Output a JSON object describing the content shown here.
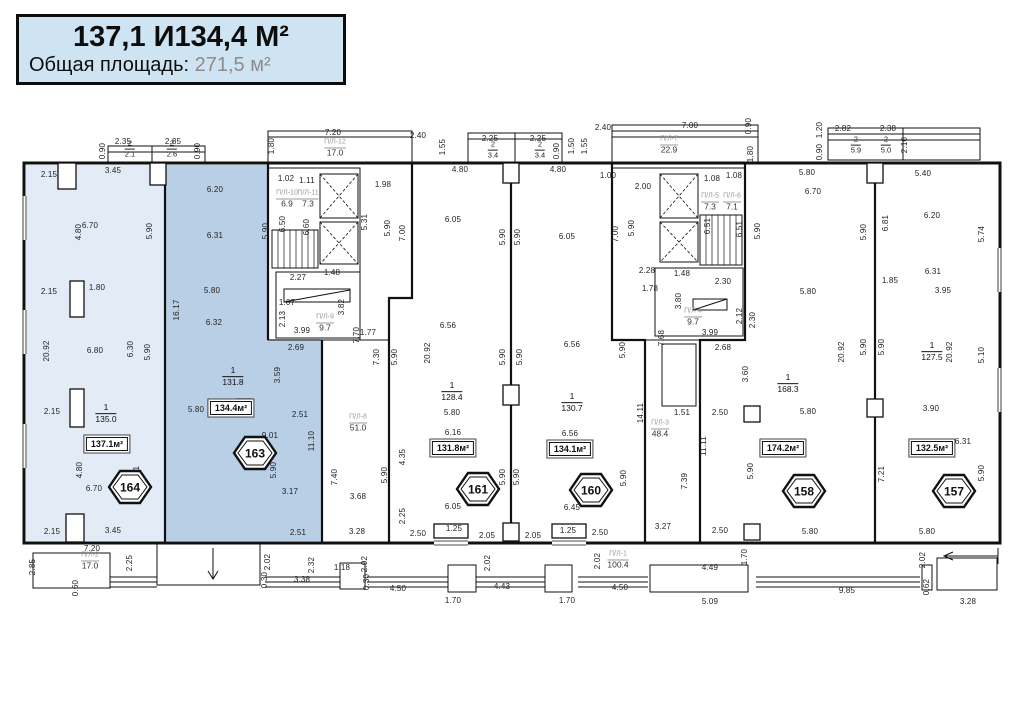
{
  "title": {
    "line1": "137,1 И134,4 М²",
    "line2_label": "Общая площадь:",
    "line2_value": "271,5 м²"
  },
  "plan": {
    "units": [
      {
        "id": "164",
        "total": "137.1м²",
        "num": "1",
        "living": "135.0",
        "hx": 107,
        "hy": 468,
        "bx": 107,
        "by": 444,
        "fx": 106,
        "fy": 414
      },
      {
        "id": "163",
        "total": "134.4м²",
        "num": "1",
        "living": "131.8",
        "hx": 232,
        "hy": 434,
        "bx": 231,
        "by": 408,
        "fx": 233,
        "fy": 377
      },
      {
        "id": "161",
        "total": "131.8м²",
        "num": "1",
        "living": "128.4",
        "hx": 455,
        "hy": 470,
        "bx": 453,
        "by": 448,
        "fx": 452,
        "fy": 392
      },
      {
        "id": "160",
        "total": "134.1м²",
        "num": "1",
        "living": "130.7",
        "hx": 568,
        "hy": 471,
        "bx": 570,
        "by": 449,
        "fx": 572,
        "fy": 403
      },
      {
        "id": "158",
        "total": "174.2м²",
        "num": "1",
        "living": "168.3",
        "hx": 781,
        "hy": 472,
        "bx": 783,
        "by": 448,
        "fx": 788,
        "fy": 384
      },
      {
        "id": "157",
        "total": "132.5м²",
        "num": "1",
        "living": "127.5",
        "hx": 931,
        "hy": 472,
        "bx": 932,
        "by": 448,
        "fx": 932,
        "fy": 352
      }
    ],
    "loggias": [
      {
        "x": 335,
        "y": 148,
        "name": "П/Л-12",
        "value": "17.0"
      },
      {
        "x": 669,
        "y": 145,
        "name": "П/Л-7",
        "value": "22.9"
      },
      {
        "x": 287,
        "y": 199,
        "name": "П/Л-10",
        "value": "6.9"
      },
      {
        "x": 308,
        "y": 199,
        "name": "П/Л-11",
        "value": "7.3"
      },
      {
        "x": 710,
        "y": 202,
        "name": "П/Л-5",
        "value": "7.3"
      },
      {
        "x": 732,
        "y": 202,
        "name": "П/Л-6",
        "value": "7.1"
      },
      {
        "x": 325,
        "y": 323,
        "name": "П/Л-9",
        "value": "9.7"
      },
      {
        "x": 693,
        "y": 317,
        "name": "П/Л-4",
        "value": "9.7"
      },
      {
        "x": 358,
        "y": 423,
        "name": "П/Л-8",
        "value": "51.0"
      },
      {
        "x": 660,
        "y": 429,
        "name": "П/Л-3",
        "value": "48.4"
      },
      {
        "x": 90,
        "y": 561,
        "name": "П/Л-2",
        "value": "17.0"
      },
      {
        "x": 618,
        "y": 560,
        "name": "П/Л-1",
        "value": "100.4"
      }
    ],
    "fractions": [
      {
        "x": 130,
        "y": 149,
        "num": "2",
        "den": "2.1"
      },
      {
        "x": 172,
        "y": 149,
        "num": "2",
        "den": "2.6"
      },
      {
        "x": 493,
        "y": 150,
        "num": "2",
        "den": "3.4"
      },
      {
        "x": 540,
        "y": 150,
        "num": "2",
        "den": "3.4"
      },
      {
        "x": 856,
        "y": 145,
        "num": "2",
        "den": "5.9"
      },
      {
        "x": 886,
        "y": 145,
        "num": "2",
        "den": "5.0"
      }
    ],
    "dims": [
      {
        "x": 103,
        "y": 151,
        "t": "0.90",
        "v": 1
      },
      {
        "x": 123,
        "y": 142,
        "t": "2.35"
      },
      {
        "x": 173,
        "y": 142,
        "t": "2.85"
      },
      {
        "x": 198,
        "y": 151,
        "t": "0.90",
        "v": 1
      },
      {
        "x": 272,
        "y": 146,
        "t": "1.80",
        "v": 1
      },
      {
        "x": 333,
        "y": 133,
        "t": "7.20"
      },
      {
        "x": 418,
        "y": 136,
        "t": "2.40"
      },
      {
        "x": 443,
        "y": 147,
        "t": "1.55",
        "v": 1
      },
      {
        "x": 490,
        "y": 139,
        "t": "2.25"
      },
      {
        "x": 538,
        "y": 139,
        "t": "2.25"
      },
      {
        "x": 557,
        "y": 151,
        "t": "0.90",
        "v": 1
      },
      {
        "x": 572,
        "y": 146,
        "t": "1.50",
        "v": 1
      },
      {
        "x": 603,
        "y": 128,
        "t": "2.40"
      },
      {
        "x": 585,
        "y": 146,
        "t": "1.55",
        "v": 1
      },
      {
        "x": 690,
        "y": 126,
        "t": "7.00"
      },
      {
        "x": 749,
        "y": 126,
        "t": "0.90",
        "v": 1
      },
      {
        "x": 751,
        "y": 154,
        "t": "1.80",
        "v": 1
      },
      {
        "x": 843,
        "y": 129,
        "t": "2.82"
      },
      {
        "x": 888,
        "y": 129,
        "t": "2.38"
      },
      {
        "x": 820,
        "y": 130,
        "t": "1.20",
        "v": 1
      },
      {
        "x": 820,
        "y": 152,
        "t": "0.90",
        "v": 1
      },
      {
        "x": 905,
        "y": 145,
        "t": "2.10",
        "v": 1
      },
      {
        "x": 460,
        "y": 170,
        "t": "4.80"
      },
      {
        "x": 558,
        "y": 170,
        "t": "4.80"
      },
      {
        "x": 608,
        "y": 176,
        "t": "1.00"
      },
      {
        "x": 643,
        "y": 187,
        "t": "2.00"
      },
      {
        "x": 712,
        "y": 179,
        "t": "1.08"
      },
      {
        "x": 734,
        "y": 176,
        "t": "1.08"
      },
      {
        "x": 807,
        "y": 173,
        "t": "5.80"
      },
      {
        "x": 923,
        "y": 174,
        "t": "5.40"
      },
      {
        "x": 49,
        "y": 175,
        "t": "2.15"
      },
      {
        "x": 113,
        "y": 171,
        "t": "3.45"
      },
      {
        "x": 90,
        "y": 226,
        "t": "6.70"
      },
      {
        "x": 79,
        "y": 232,
        "t": "4.80",
        "v": 1
      },
      {
        "x": 150,
        "y": 231,
        "t": "5.90",
        "v": 1
      },
      {
        "x": 49,
        "y": 292,
        "t": "2.15"
      },
      {
        "x": 97,
        "y": 288,
        "t": "1.80"
      },
      {
        "x": 47,
        "y": 351,
        "t": "20.92",
        "v": 1
      },
      {
        "x": 95,
        "y": 351,
        "t": "6.80"
      },
      {
        "x": 131,
        "y": 349,
        "t": "6.30",
        "v": 1
      },
      {
        "x": 148,
        "y": 352,
        "t": "5.90",
        "v": 1
      },
      {
        "x": 52,
        "y": 412,
        "t": "2.15"
      },
      {
        "x": 80,
        "y": 470,
        "t": "4.80",
        "v": 1
      },
      {
        "x": 94,
        "y": 489,
        "t": "6.70"
      },
      {
        "x": 137,
        "y": 474,
        "t": "7.21",
        "v": 1
      },
      {
        "x": 52,
        "y": 532,
        "t": "2.15"
      },
      {
        "x": 113,
        "y": 531,
        "t": "3.45"
      },
      {
        "x": 215,
        "y": 190,
        "t": "6.20"
      },
      {
        "x": 215,
        "y": 236,
        "t": "6.31"
      },
      {
        "x": 212,
        "y": 291,
        "t": "5.80"
      },
      {
        "x": 214,
        "y": 323,
        "t": "6.32"
      },
      {
        "x": 177,
        "y": 310,
        "t": "16.17",
        "v": 1
      },
      {
        "x": 266,
        "y": 231,
        "t": "5.90",
        "v": 1
      },
      {
        "x": 296,
        "y": 348,
        "t": "2.69"
      },
      {
        "x": 278,
        "y": 375,
        "t": "3.59",
        "v": 1
      },
      {
        "x": 300,
        "y": 415,
        "t": "2.51"
      },
      {
        "x": 196,
        "y": 410,
        "t": "5.80"
      },
      {
        "x": 270,
        "y": 436,
        "t": "9.01"
      },
      {
        "x": 312,
        "y": 441,
        "t": "11.10",
        "v": 1
      },
      {
        "x": 274,
        "y": 470,
        "t": "5.90",
        "v": 1
      },
      {
        "x": 290,
        "y": 492,
        "t": "3.17"
      },
      {
        "x": 298,
        "y": 533,
        "t": "2.51"
      },
      {
        "x": 286,
        "y": 179,
        "t": "1.02"
      },
      {
        "x": 307,
        "y": 181,
        "t": "1.11"
      },
      {
        "x": 283,
        "y": 224,
        "t": "6.50",
        "v": 1
      },
      {
        "x": 307,
        "y": 227,
        "t": "6.60",
        "v": 1
      },
      {
        "x": 365,
        "y": 222,
        "t": "5.31",
        "v": 1
      },
      {
        "x": 383,
        "y": 185,
        "t": "1.98"
      },
      {
        "x": 388,
        "y": 228,
        "t": "5.90",
        "v": 1
      },
      {
        "x": 403,
        "y": 233,
        "t": "7.00",
        "v": 1
      },
      {
        "x": 298,
        "y": 278,
        "t": "2.27"
      },
      {
        "x": 332,
        "y": 273,
        "t": "1.48"
      },
      {
        "x": 342,
        "y": 307,
        "t": "3.82",
        "v": 1
      },
      {
        "x": 287,
        "y": 303,
        "t": "1.07"
      },
      {
        "x": 283,
        "y": 319,
        "t": "2.13",
        "v": 1
      },
      {
        "x": 302,
        "y": 331,
        "t": "3.99"
      },
      {
        "x": 357,
        "y": 335,
        "t": "7.70",
        "v": 1
      },
      {
        "x": 368,
        "y": 333,
        "t": "1.77"
      },
      {
        "x": 377,
        "y": 357,
        "t": "7.30",
        "v": 1
      },
      {
        "x": 395,
        "y": 357,
        "t": "5.90",
        "v": 1
      },
      {
        "x": 335,
        "y": 477,
        "t": "7.40",
        "v": 1
      },
      {
        "x": 358,
        "y": 497,
        "t": "3.68"
      },
      {
        "x": 357,
        "y": 532,
        "t": "3.28"
      },
      {
        "x": 385,
        "y": 475,
        "t": "5.90",
        "v": 1
      },
      {
        "x": 403,
        "y": 457,
        "t": "4.35",
        "v": 1
      },
      {
        "x": 403,
        "y": 516,
        "t": "2.25",
        "v": 1
      },
      {
        "x": 453,
        "y": 220,
        "t": "6.05"
      },
      {
        "x": 503,
        "y": 237,
        "t": "5.90",
        "v": 1
      },
      {
        "x": 518,
        "y": 237,
        "t": "5.90",
        "v": 1
      },
      {
        "x": 448,
        "y": 326,
        "t": "6.56"
      },
      {
        "x": 428,
        "y": 353,
        "t": "20.92",
        "v": 1
      },
      {
        "x": 452,
        "y": 413,
        "t": "5.80"
      },
      {
        "x": 453,
        "y": 433,
        "t": "6.16"
      },
      {
        "x": 453,
        "y": 507,
        "t": "6.05"
      },
      {
        "x": 454,
        "y": 529,
        "t": "1.25"
      },
      {
        "x": 418,
        "y": 534,
        "t": "2.50"
      },
      {
        "x": 487,
        "y": 536,
        "t": "2.05"
      },
      {
        "x": 503,
        "y": 477,
        "t": "5.90",
        "v": 1
      },
      {
        "x": 517,
        "y": 477,
        "t": "5.90",
        "v": 1
      },
      {
        "x": 567,
        "y": 237,
        "t": "6.05"
      },
      {
        "x": 572,
        "y": 345,
        "t": "6.56"
      },
      {
        "x": 570,
        "y": 434,
        "t": "6.56"
      },
      {
        "x": 572,
        "y": 508,
        "t": "6.45"
      },
      {
        "x": 568,
        "y": 531,
        "t": "1.25"
      },
      {
        "x": 600,
        "y": 533,
        "t": "2.50"
      },
      {
        "x": 533,
        "y": 536,
        "t": "2.05"
      },
      {
        "x": 503,
        "y": 357,
        "t": "5.90",
        "v": 1
      },
      {
        "x": 520,
        "y": 357,
        "t": "5.90",
        "v": 1
      },
      {
        "x": 632,
        "y": 228,
        "t": "5.90",
        "v": 1
      },
      {
        "x": 616,
        "y": 234,
        "t": "7.00",
        "v": 1
      },
      {
        "x": 623,
        "y": 350,
        "t": "5.90",
        "v": 1
      },
      {
        "x": 708,
        "y": 226,
        "t": "6.51",
        "v": 1
      },
      {
        "x": 740,
        "y": 229,
        "t": "6.51",
        "v": 1
      },
      {
        "x": 758,
        "y": 231,
        "t": "5.90",
        "v": 1
      },
      {
        "x": 647,
        "y": 271,
        "t": "2.28"
      },
      {
        "x": 682,
        "y": 274,
        "t": "1.48"
      },
      {
        "x": 650,
        "y": 289,
        "t": "1.78"
      },
      {
        "x": 723,
        "y": 282,
        "t": "2.30"
      },
      {
        "x": 679,
        "y": 301,
        "t": "3.80",
        "v": 1
      },
      {
        "x": 740,
        "y": 316,
        "t": "2.12",
        "v": 1
      },
      {
        "x": 753,
        "y": 320,
        "t": "2.30",
        "v": 1
      },
      {
        "x": 710,
        "y": 333,
        "t": "3.99"
      },
      {
        "x": 723,
        "y": 348,
        "t": "2.68"
      },
      {
        "x": 662,
        "y": 338,
        "t": "7.68",
        "v": 1
      },
      {
        "x": 746,
        "y": 374,
        "t": "3.60",
        "v": 1
      },
      {
        "x": 641,
        "y": 413,
        "t": "14.11",
        "v": 1
      },
      {
        "x": 682,
        "y": 413,
        "t": "1.51"
      },
      {
        "x": 704,
        "y": 446,
        "t": "11.11",
        "v": 1
      },
      {
        "x": 685,
        "y": 481,
        "t": "7.39",
        "v": 1
      },
      {
        "x": 624,
        "y": 478,
        "t": "5.90",
        "v": 1
      },
      {
        "x": 663,
        "y": 527,
        "t": "3.27"
      },
      {
        "x": 813,
        "y": 192,
        "t": "6.70"
      },
      {
        "x": 864,
        "y": 232,
        "t": "5.90",
        "v": 1
      },
      {
        "x": 808,
        "y": 292,
        "t": "5.80"
      },
      {
        "x": 720,
        "y": 413,
        "t": "2.50"
      },
      {
        "x": 808,
        "y": 412,
        "t": "5.80"
      },
      {
        "x": 751,
        "y": 471,
        "t": "5.90",
        "v": 1
      },
      {
        "x": 842,
        "y": 352,
        "t": "20.92",
        "v": 1
      },
      {
        "x": 864,
        "y": 347,
        "t": "5.90",
        "v": 1
      },
      {
        "x": 720,
        "y": 531,
        "t": "2.50"
      },
      {
        "x": 810,
        "y": 532,
        "t": "5.80"
      },
      {
        "x": 932,
        "y": 216,
        "t": "6.20"
      },
      {
        "x": 886,
        "y": 223,
        "t": "6.81",
        "v": 1
      },
      {
        "x": 982,
        "y": 234,
        "t": "5.74",
        "v": 1
      },
      {
        "x": 933,
        "y": 272,
        "t": "6.31"
      },
      {
        "x": 943,
        "y": 291,
        "t": "3.95"
      },
      {
        "x": 890,
        "y": 281,
        "t": "1.85"
      },
      {
        "x": 882,
        "y": 347,
        "t": "5.90",
        "v": 1
      },
      {
        "x": 950,
        "y": 352,
        "t": "20.92",
        "v": 1
      },
      {
        "x": 982,
        "y": 355,
        "t": "5.10",
        "v": 1
      },
      {
        "x": 931,
        "y": 409,
        "t": "3.90"
      },
      {
        "x": 963,
        "y": 442,
        "t": "6.31"
      },
      {
        "x": 882,
        "y": 474,
        "t": "7.21",
        "v": 1
      },
      {
        "x": 982,
        "y": 473,
        "t": "5.90",
        "v": 1
      },
      {
        "x": 927,
        "y": 532,
        "t": "5.80"
      },
      {
        "x": 92,
        "y": 549,
        "t": "7.20"
      },
      {
        "x": 33,
        "y": 567,
        "t": "2.85",
        "v": 1
      },
      {
        "x": 130,
        "y": 563,
        "t": "2.25",
        "v": 1
      },
      {
        "x": 76,
        "y": 588,
        "t": "0.60",
        "v": 1
      },
      {
        "x": 268,
        "y": 562,
        "t": "2.02",
        "v": 1
      },
      {
        "x": 265,
        "y": 580,
        "t": "0.30",
        "v": 1
      },
      {
        "x": 302,
        "y": 580,
        "t": "3.38"
      },
      {
        "x": 312,
        "y": 565,
        "t": "2.32",
        "v": 1
      },
      {
        "x": 342,
        "y": 568,
        "t": "1.18"
      },
      {
        "x": 365,
        "y": 564,
        "t": "2.02",
        "v": 1
      },
      {
        "x": 367,
        "y": 582,
        "t": "0.30",
        "v": 1
      },
      {
        "x": 398,
        "y": 589,
        "t": "4.50"
      },
      {
        "x": 453,
        "y": 601,
        "t": "1.70"
      },
      {
        "x": 502,
        "y": 587,
        "t": "4.43"
      },
      {
        "x": 488,
        "y": 563,
        "t": "2.02",
        "v": 1
      },
      {
        "x": 598,
        "y": 561,
        "t": "2.02",
        "v": 1
      },
      {
        "x": 567,
        "y": 601,
        "t": "1.70"
      },
      {
        "x": 620,
        "y": 588,
        "t": "4.50"
      },
      {
        "x": 710,
        "y": 568,
        "t": "4.49"
      },
      {
        "x": 745,
        "y": 557,
        "t": "1.70",
        "v": 1
      },
      {
        "x": 710,
        "y": 602,
        "t": "5.09"
      },
      {
        "x": 847,
        "y": 591,
        "t": "9.85"
      },
      {
        "x": 923,
        "y": 560,
        "t": "2.02",
        "v": 1
      },
      {
        "x": 927,
        "y": 587,
        "t": "0.62",
        "v": 1
      },
      {
        "x": 968,
        "y": 602,
        "t": "3.28"
      }
    ]
  }
}
